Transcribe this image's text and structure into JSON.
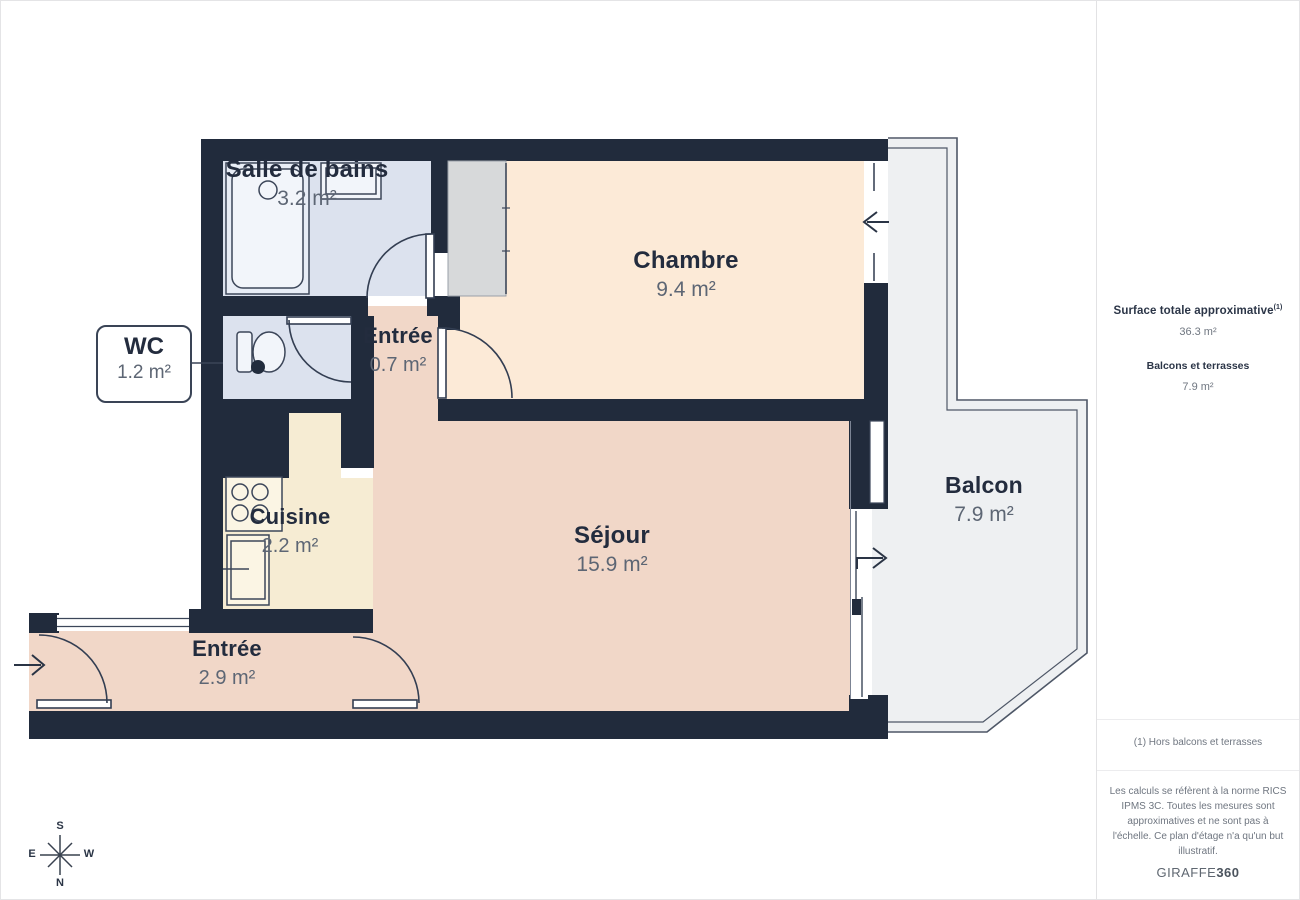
{
  "rooms": {
    "salle_de_bains": {
      "name": "Salle de bains",
      "area": "3.2 m²"
    },
    "chambre": {
      "name": "Chambre",
      "area": "9.4 m²"
    },
    "wc": {
      "name": "WC",
      "area": "1.2 m²"
    },
    "entree_haut": {
      "name": "Entrée",
      "area": "0.7 m²"
    },
    "cuisine": {
      "name": "Cuisine",
      "area": "2.2 m²"
    },
    "sejour": {
      "name": "Séjour",
      "area": "15.9 m²"
    },
    "entree_bas": {
      "name": "Entrée",
      "area": "2.9 m²"
    },
    "balcon": {
      "name": "Balcon",
      "area": "7.9 m²"
    }
  },
  "sidebar": {
    "total_label": "Surface totale approximative",
    "total_sup": "(1)",
    "total_value": "36.3 m²",
    "balcony_label": "Balcons et terrasses",
    "balcony_value": "7.9 m²",
    "footnote": "(1) Hors balcons et terrasses",
    "disclaimer": "Les calculs se réfèrent à la norme RICS IPMS 3C. Toutes les mesures sont approximatives et ne sont pas à l'échelle. Ce plan d'étage n'a qu'un but illustratif.",
    "brand_name": "GIRAFFE",
    "brand_bold": "360"
  },
  "compass": {
    "top": "S",
    "right": "W",
    "bottom": "N",
    "left": "E"
  },
  "palette": {
    "wall": "#212b3c",
    "bathroom_fill": "#dce2ee",
    "chambre_fill": "#fcead7",
    "salmon_fill": "#f1d7c8",
    "cuisine_fill": "#f6ecd3",
    "closet_fill": "#d7d9da",
    "balcony_fill": "#eef0f2",
    "name_text": "#232c3e",
    "area_text": "#5d6674"
  }
}
